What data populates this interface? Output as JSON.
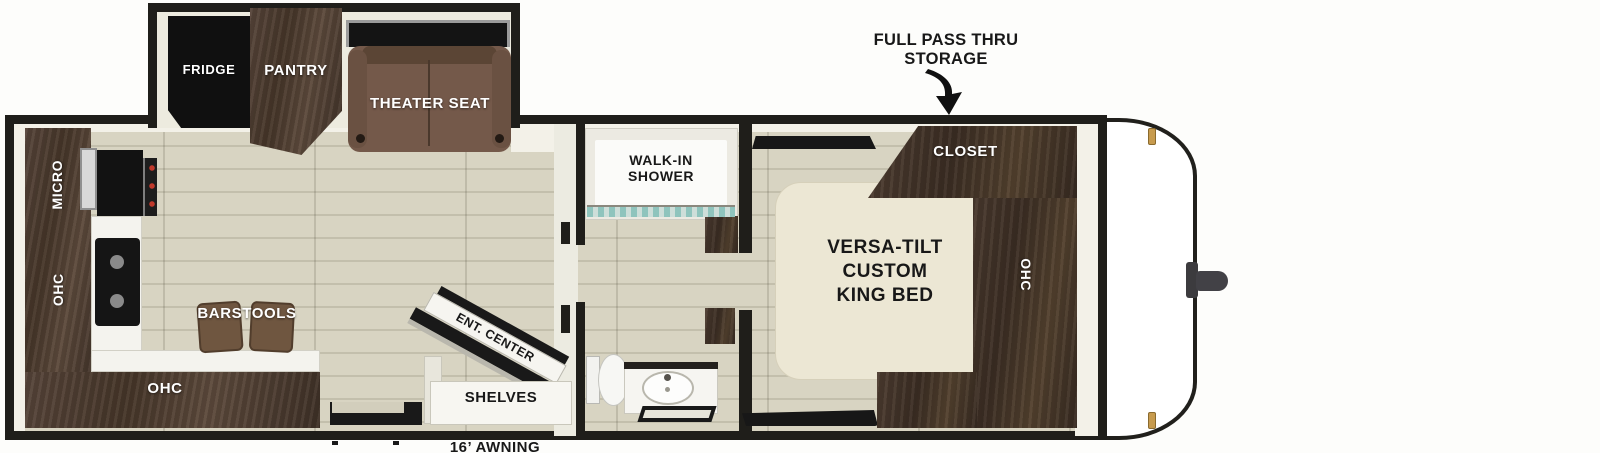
{
  "callouts": {
    "full_pass_thru_line1": "FULL PASS THRU",
    "full_pass_thru_line2": "STORAGE",
    "awning": "16’ AWNING"
  },
  "slide_out": {
    "fridge": "FRIDGE",
    "pantry": "PANTRY",
    "theater_seat": "THEATER SEAT"
  },
  "kitchen": {
    "micro": "MICRO",
    "ohc_left_wall": "OHC",
    "barstools": "BARSTOOLS",
    "ohc_rear": "OHC"
  },
  "living_area": {
    "ent_center": "ENT. CENTER",
    "shelves": "SHELVES"
  },
  "bathroom": {
    "walk_in_shower_line1": "WALK-IN",
    "walk_in_shower_line2": "SHOWER"
  },
  "bedroom": {
    "bed_line1": "VERSA-TILT",
    "bed_line2": "CUSTOM",
    "bed_line3": "KING BED",
    "closet": "CLOSET",
    "ohc": "OHC"
  },
  "colors": {
    "wall": "#1f1e1a",
    "floor_tan": "#d6d2c0",
    "dark_wood": "#4a3a2f",
    "theater_brown": "#73594a",
    "bed_cream": "#ece7d4",
    "shower_glass": "#8fc4bd",
    "marker_gold": "#c79b4e"
  }
}
